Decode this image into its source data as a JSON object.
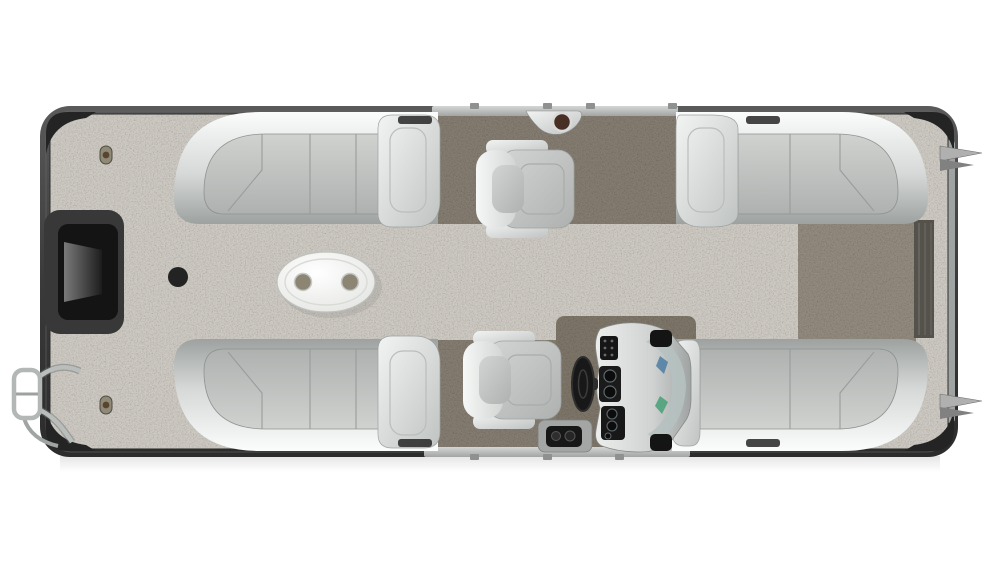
{
  "page": {
    "background_color": "#ffffff",
    "description": "Top-down 3D render of a pontoon boat seating floor plan, hull horizontal"
  },
  "boat": {
    "hull": {
      "rub_rail_color": "#3d3d3d",
      "corner_cap_color": "#242424",
      "deck_rail_color": "#c3c6c5",
      "cleat_color": "#b0b0b0",
      "cleat_count": 2,
      "stern_gate_color": "#55514b",
      "bow_recess_color": "#141414"
    },
    "carpet": {
      "bow_color": "#a5a19b",
      "helm_area_color": "#665f55",
      "stern_walkway_color": "#6e675d"
    },
    "furniture": {
      "lounges": [
        {
          "id": "front-port",
          "type": "corner-lounge",
          "cushion_color": "#c6c8c6"
        },
        {
          "id": "front-starboard",
          "type": "corner-lounge",
          "cushion_color": "#c6c8c6"
        },
        {
          "id": "rear-port",
          "type": "corner-lounge",
          "cushion_color": "#c6c8c6"
        },
        {
          "id": "rear-starboard",
          "type": "corner-lounge",
          "cushion_color": "#c6c8c6"
        }
      ],
      "captain_chairs": [
        {
          "id": "forward-chair",
          "facing": "right"
        },
        {
          "id": "helm-chair",
          "facing": "right"
        }
      ],
      "table": {
        "shape": "oval",
        "top_color": "#f2f3f1",
        "cupholder_count": 2,
        "cupholder_color": "#8d8574"
      },
      "helm_console": {
        "body_color": "#dfe2e1",
        "panel_color": "#1a1a1a",
        "steering_wheel_color": "#181818",
        "windshield_color": "#b5c1c0",
        "glint_blue": "#4c7ca3",
        "glint_green": "#3f9e70",
        "gauge_count": 5,
        "mount_pad_color": "#141414"
      },
      "accessories": {
        "rail_cupholder_drink_color": "#472f23",
        "boarding_ladder_finish": "#b3b7b6",
        "floor_ring_color": "#232323",
        "deck_latch_color": "#8f8a78",
        "deck_latch_count": 2,
        "throttle_unit_color": "#171717"
      }
    }
  }
}
